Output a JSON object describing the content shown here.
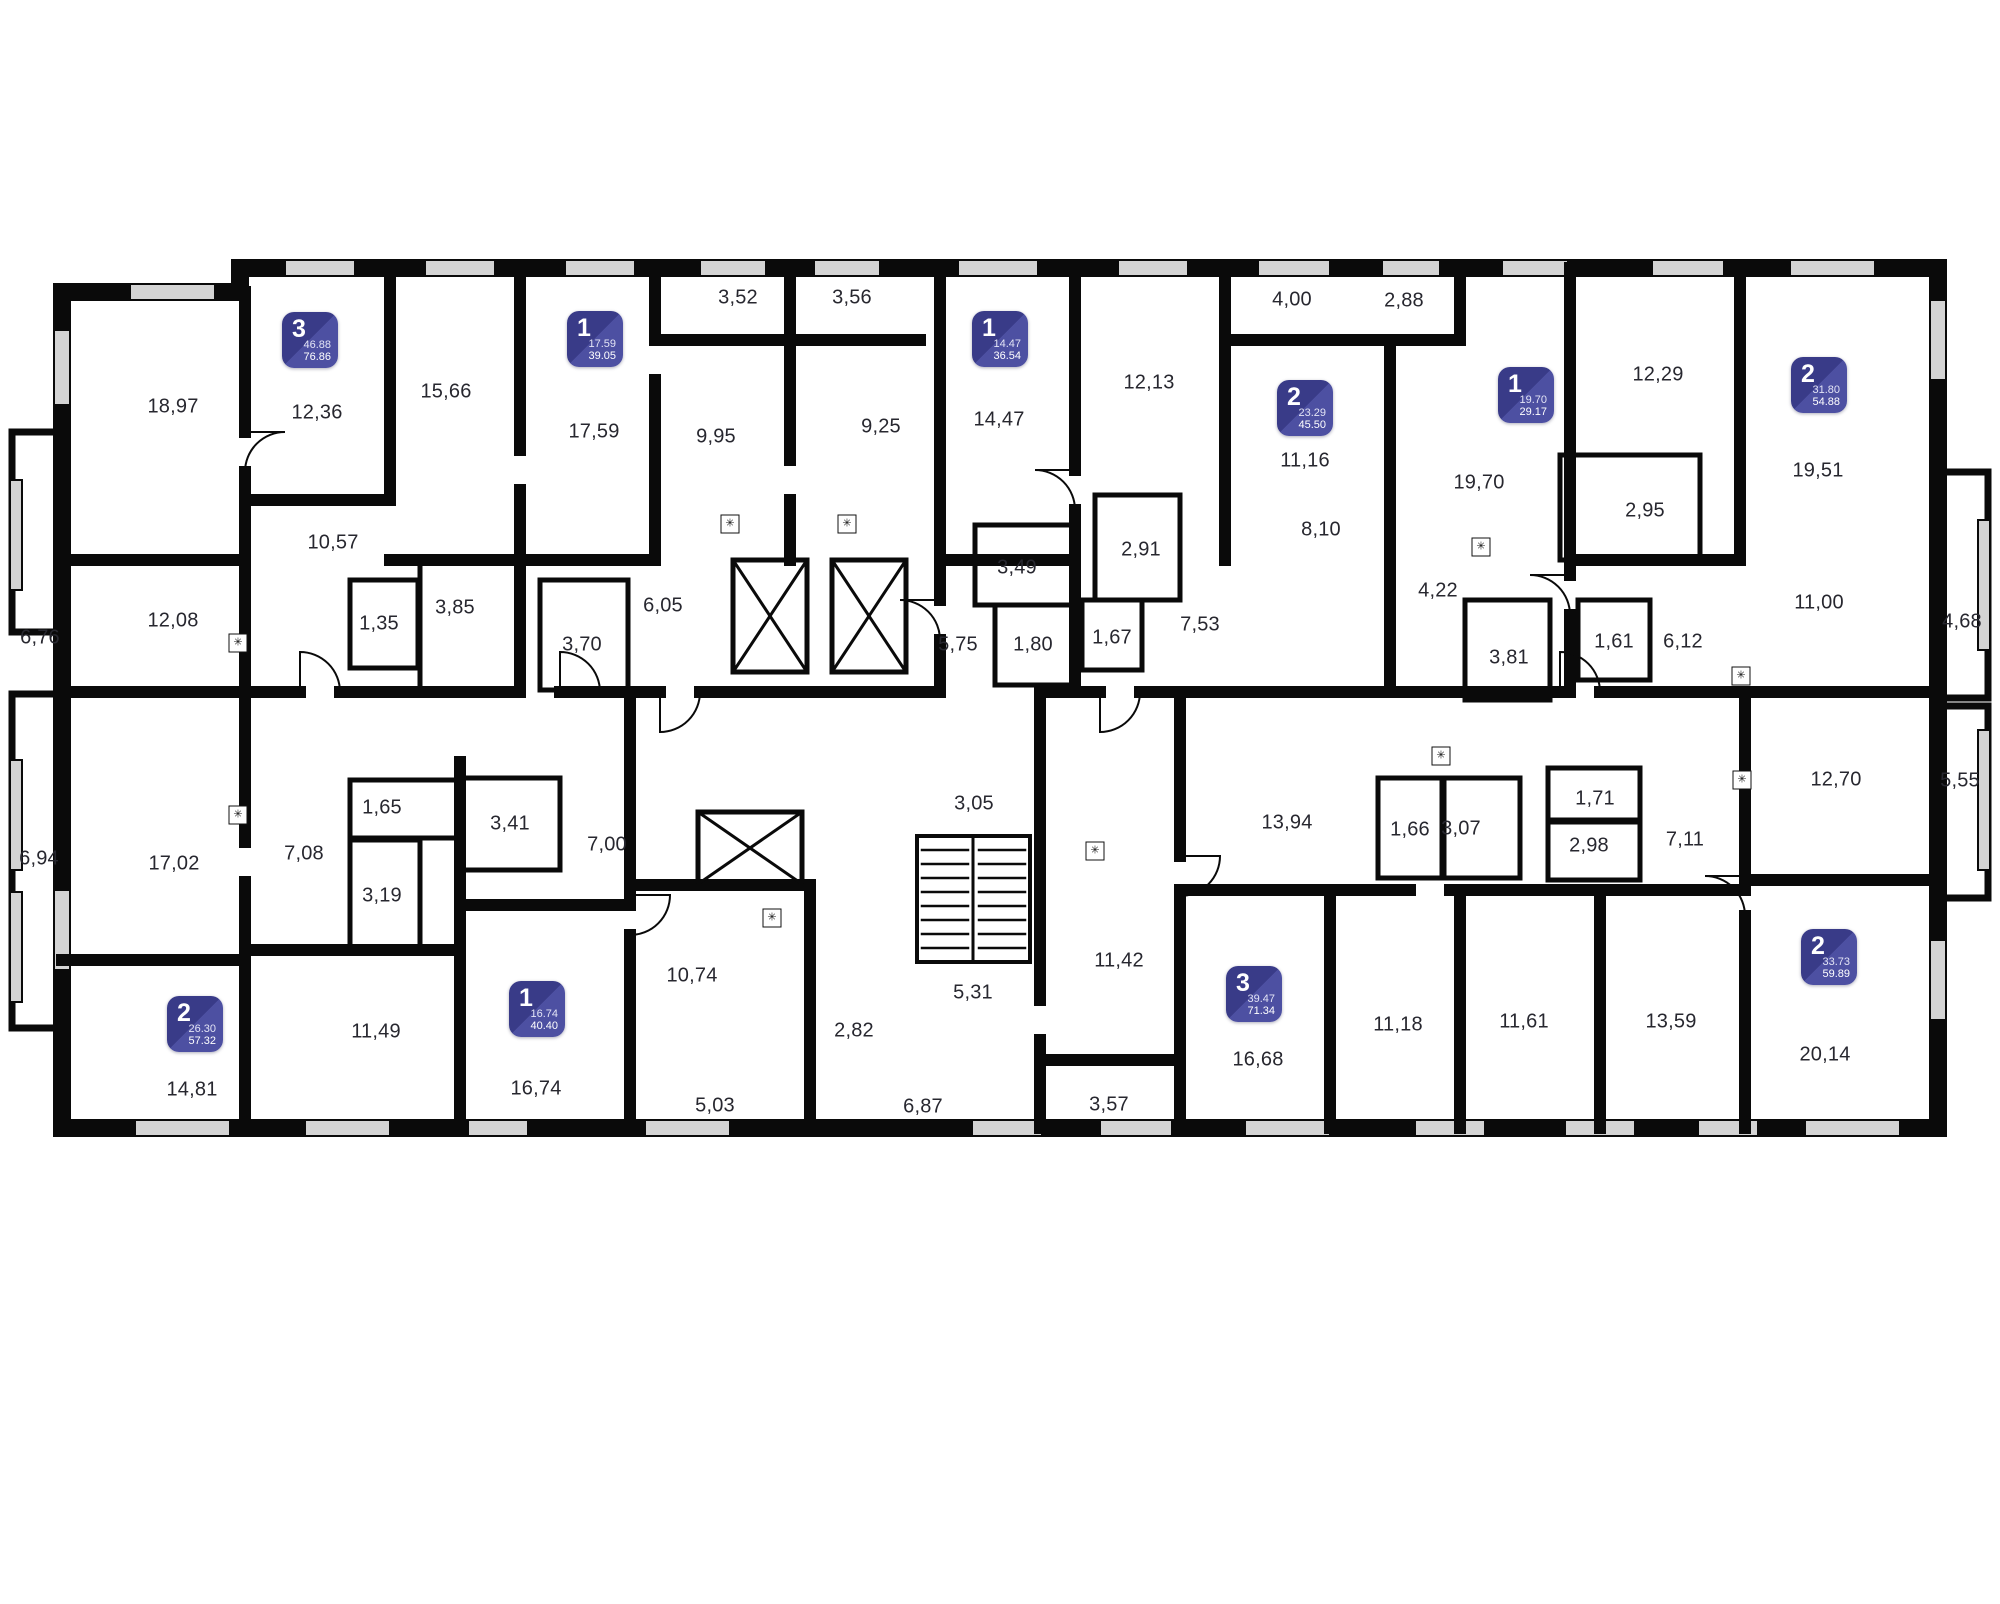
{
  "title": "apartment-floor-plan",
  "colors": {
    "wall": "#0a0a0a",
    "background": "#ffffff",
    "window": "#d4d4d4",
    "label_text": "#27272f",
    "badge_dark": "#393b88",
    "badge_light": "#4d50a2",
    "badge_text": "#ffffff"
  },
  "icons": {
    "kitchen_vent": "✳",
    "elevator": "elevator-shaft-x",
    "stairs": "staircase-treads"
  },
  "apartments": [
    {
      "type": "3",
      "area_living": "46.88",
      "area_total": "76.86",
      "x": 282,
      "y": 312
    },
    {
      "type": "1",
      "area_living": "17.59",
      "area_total": "39.05",
      "x": 567,
      "y": 311
    },
    {
      "type": "1",
      "area_living": "14.47",
      "area_total": "36.54",
      "x": 972,
      "y": 311
    },
    {
      "type": "2",
      "area_living": "23.29",
      "area_total": "45.50",
      "x": 1277,
      "y": 380
    },
    {
      "type": "1",
      "area_living": "19.70",
      "area_total": "29.17",
      "x": 1498,
      "y": 367
    },
    {
      "type": "2",
      "area_living": "31.80",
      "area_total": "54.88",
      "x": 1791,
      "y": 357
    },
    {
      "type": "2",
      "area_living": "26.30",
      "area_total": "57.32",
      "x": 167,
      "y": 996
    },
    {
      "type": "1",
      "area_living": "16.74",
      "area_total": "40.40",
      "x": 509,
      "y": 981
    },
    {
      "type": "3",
      "area_living": "39.47",
      "area_total": "71.34",
      "x": 1226,
      "y": 966
    },
    {
      "type": "2",
      "area_living": "33.73",
      "area_total": "59.89",
      "x": 1801,
      "y": 929
    }
  ],
  "rooms": [
    {
      "v": "18,97",
      "x": 173,
      "y": 407
    },
    {
      "v": "12,36",
      "x": 317,
      "y": 413
    },
    {
      "v": "15,66",
      "x": 446,
      "y": 392
    },
    {
      "v": "17,59",
      "x": 594,
      "y": 432
    },
    {
      "v": "3,52",
      "x": 738,
      "y": 298
    },
    {
      "v": "3,56",
      "x": 852,
      "y": 298
    },
    {
      "v": "9,95",
      "x": 716,
      "y": 437
    },
    {
      "v": "9,25",
      "x": 881,
      "y": 427
    },
    {
      "v": "14,47",
      "x": 999,
      "y": 420
    },
    {
      "v": "12,13",
      "x": 1149,
      "y": 383
    },
    {
      "v": "4,00",
      "x": 1292,
      "y": 300
    },
    {
      "v": "2,88",
      "x": 1404,
      "y": 301
    },
    {
      "v": "11,16",
      "x": 1305,
      "y": 461
    },
    {
      "v": "8,10",
      "x": 1321,
      "y": 530
    },
    {
      "v": "19,70",
      "x": 1479,
      "y": 483
    },
    {
      "v": "12,29",
      "x": 1658,
      "y": 375
    },
    {
      "v": "19,51",
      "x": 1818,
      "y": 471
    },
    {
      "v": "10,57",
      "x": 333,
      "y": 543
    },
    {
      "v": "12,08",
      "x": 173,
      "y": 621
    },
    {
      "v": "6,76",
      "x": 40,
      "y": 638
    },
    {
      "v": "1,35",
      "x": 379,
      "y": 624
    },
    {
      "v": "3,85",
      "x": 455,
      "y": 608
    },
    {
      "v": "3,70",
      "x": 582,
      "y": 645
    },
    {
      "v": "6,05",
      "x": 663,
      "y": 606
    },
    {
      "v": "3,49",
      "x": 1017,
      "y": 568
    },
    {
      "v": "2,91",
      "x": 1141,
      "y": 550
    },
    {
      "v": "5,75",
      "x": 958,
      "y": 645
    },
    {
      "v": "1,80",
      "x": 1033,
      "y": 645
    },
    {
      "v": "1,67",
      "x": 1112,
      "y": 638
    },
    {
      "v": "7,53",
      "x": 1200,
      "y": 625
    },
    {
      "v": "4,22",
      "x": 1438,
      "y": 591
    },
    {
      "v": "3,81",
      "x": 1509,
      "y": 658
    },
    {
      "v": "1,61",
      "x": 1614,
      "y": 642
    },
    {
      "v": "6,12",
      "x": 1683,
      "y": 642
    },
    {
      "v": "2,95",
      "x": 1645,
      "y": 511
    },
    {
      "v": "11,00",
      "x": 1819,
      "y": 603
    },
    {
      "v": "4,68",
      "x": 1962,
      "y": 622
    },
    {
      "v": "6,94",
      "x": 39,
      "y": 859
    },
    {
      "v": "17,02",
      "x": 174,
      "y": 864
    },
    {
      "v": "7,08",
      "x": 304,
      "y": 854
    },
    {
      "v": "1,65",
      "x": 382,
      "y": 808
    },
    {
      "v": "3,41",
      "x": 510,
      "y": 824
    },
    {
      "v": "3,19",
      "x": 382,
      "y": 896
    },
    {
      "v": "14,81",
      "x": 192,
      "y": 1090
    },
    {
      "v": "11,49",
      "x": 376,
      "y": 1032
    },
    {
      "v": "16,74",
      "x": 536,
      "y": 1089
    },
    {
      "v": "7,00",
      "x": 607,
      "y": 845
    },
    {
      "v": "10,74",
      "x": 692,
      "y": 976
    },
    {
      "v": "5,03",
      "x": 715,
      "y": 1106
    },
    {
      "v": "3,05",
      "x": 974,
      "y": 804
    },
    {
      "v": "5,31",
      "x": 973,
      "y": 993
    },
    {
      "v": "2,82",
      "x": 854,
      "y": 1031
    },
    {
      "v": "6,87",
      "x": 923,
      "y": 1107
    },
    {
      "v": "11,42",
      "x": 1119,
      "y": 961
    },
    {
      "v": "13,94",
      "x": 1287,
      "y": 823
    },
    {
      "v": "1,66",
      "x": 1410,
      "y": 830
    },
    {
      "v": "3,07",
      "x": 1461,
      "y": 829
    },
    {
      "v": "16,68",
      "x": 1258,
      "y": 1060
    },
    {
      "v": "11,18",
      "x": 1398,
      "y": 1025
    },
    {
      "v": "11,61",
      "x": 1524,
      "y": 1022
    },
    {
      "v": "3,57",
      "x": 1109,
      "y": 1105
    },
    {
      "v": "1,71",
      "x": 1595,
      "y": 799
    },
    {
      "v": "2,98",
      "x": 1589,
      "y": 846
    },
    {
      "v": "7,11",
      "x": 1685,
      "y": 840
    },
    {
      "v": "12,70",
      "x": 1836,
      "y": 780
    },
    {
      "v": "5,55",
      "x": 1960,
      "y": 781
    },
    {
      "v": "13,59",
      "x": 1671,
      "y": 1022
    },
    {
      "v": "20,14",
      "x": 1825,
      "y": 1055
    }
  ],
  "vents": [
    {
      "x": 238,
      "y": 643
    },
    {
      "x": 238,
      "y": 815
    },
    {
      "x": 730,
      "y": 524
    },
    {
      "x": 847,
      "y": 524
    },
    {
      "x": 1481,
      "y": 547
    },
    {
      "x": 772,
      "y": 918
    },
    {
      "x": 1095,
      "y": 851
    },
    {
      "x": 1441,
      "y": 756
    },
    {
      "x": 1741,
      "y": 676
    },
    {
      "x": 1742,
      "y": 780
    }
  ]
}
